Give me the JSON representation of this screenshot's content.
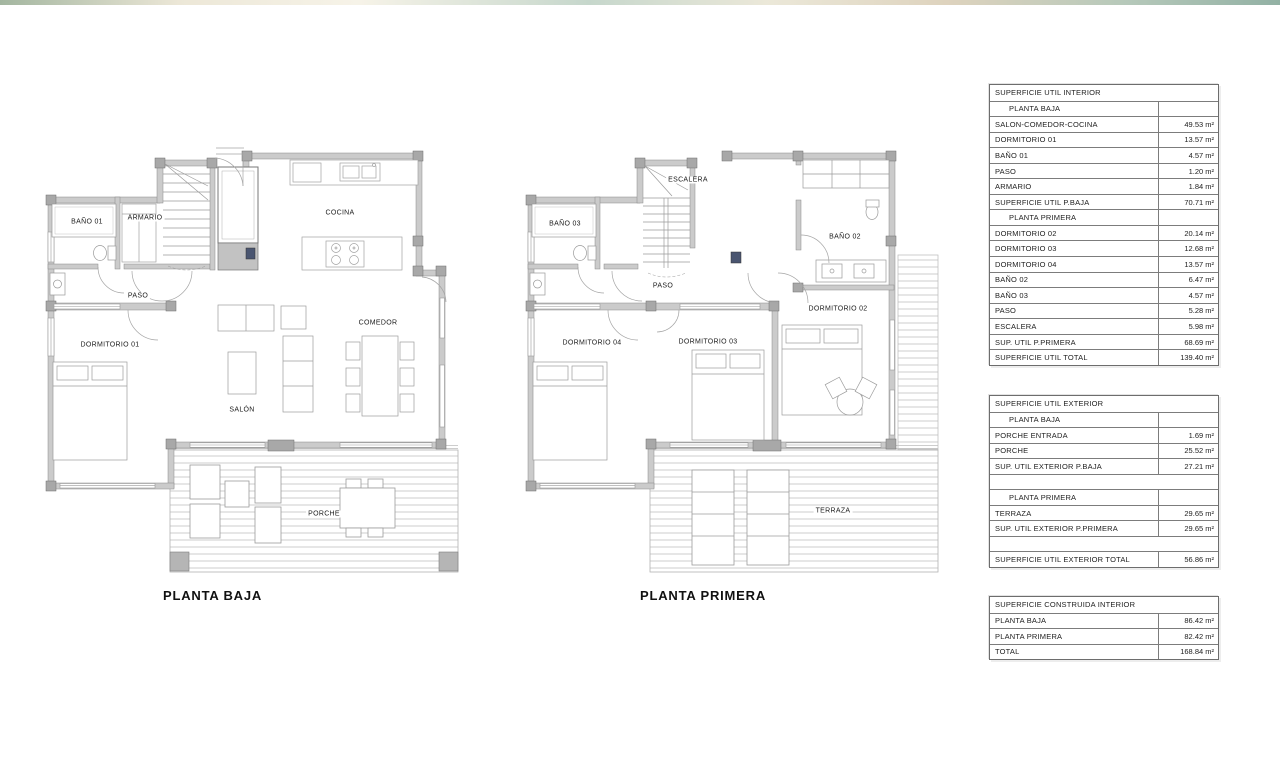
{
  "page": {
    "background": "#ffffff",
    "top_strip_colors": [
      "#93a98f",
      "#e9e3d0",
      "#bcd0c3",
      "#d8cbb2",
      "#7fa394"
    ],
    "wall_color": "#cbcbcb",
    "wall_outline": "#8a8a8a",
    "pad_color": "#aaaaaa",
    "line_color": "#9c9c9c",
    "deck_line_color": "#c9c9c9",
    "text_color": "#1b1b1b"
  },
  "plans": [
    {
      "title": "PLANTA BAJA",
      "rooms": [
        "BAÑO 01",
        "ARMARIO",
        "COCINA",
        "PASO",
        "DORMITORIO 01",
        "COMEDOR",
        "SALÓN",
        "PORCHE"
      ]
    },
    {
      "title": "PLANTA PRIMERA",
      "rooms": [
        "ESCALERA",
        "BAÑO 03",
        "BAÑO 02",
        "PASO",
        "DORMITORIO 04",
        "DORMITORIO 03",
        "DORMITORIO 02",
        "TERRAZA"
      ]
    }
  ],
  "tables": {
    "interior": {
      "rows": [
        {
          "label": "SUPERFICIE UTIL INTERIOR",
          "value": ""
        },
        {
          "label": "PLANTA BAJA",
          "value": ""
        },
        {
          "label": "SALON-COMEDOR-COCINA",
          "value": "49.53 m²"
        },
        {
          "label": "DORMITORIO 01",
          "value": "13.57 m²"
        },
        {
          "label": "BAÑO 01",
          "value": "4.57 m²"
        },
        {
          "label": "PASO",
          "value": "1.20 m²"
        },
        {
          "label": "ARMARIO",
          "value": "1.84 m²"
        },
        {
          "label": "SUPERFICIE UTIL P.BAJA",
          "value": "70.71 m²"
        },
        {
          "label": "PLANTA PRIMERA",
          "value": ""
        },
        {
          "label": "DORMITORIO 02",
          "value": "20.14 m²"
        },
        {
          "label": "DORMITORIO 03",
          "value": "12.68 m²"
        },
        {
          "label": "DORMITORIO 04",
          "value": "13.57 m²"
        },
        {
          "label": "BAÑO 02",
          "value": "6.47 m²"
        },
        {
          "label": "BAÑO 03",
          "value": "4.57 m²"
        },
        {
          "label": "PASO",
          "value": "5.28 m²"
        },
        {
          "label": "ESCALERA",
          "value": "5.98 m²"
        },
        {
          "label": "SUP. UTIL P.PRIMERA",
          "value": "68.69 m²"
        },
        {
          "label": "SUPERFICIE UTIL TOTAL",
          "value": "139.40 m²"
        }
      ]
    },
    "exterior": {
      "rows": [
        {
          "label": "SUPERFICIE UTIL EXTERIOR",
          "value": ""
        },
        {
          "label": "PLANTA BAJA",
          "value": ""
        },
        {
          "label": "PORCHE ENTRADA",
          "value": "1.69 m²"
        },
        {
          "label": "PORCHE",
          "value": "25.52 m²"
        },
        {
          "label": "SUP. UTIL EXTERIOR P.BAJA",
          "value": "27.21 m²"
        },
        {
          "label": "",
          "value": ""
        },
        {
          "label": "PLANTA PRIMERA",
          "value": ""
        },
        {
          "label": "TERRAZA",
          "value": "29.65 m²"
        },
        {
          "label": "SUP. UTIL EXTERIOR P.PRIMERA",
          "value": "29.65 m²"
        },
        {
          "label": "",
          "value": ""
        },
        {
          "label": "SUPERFICIE UTIL EXTERIOR TOTAL",
          "value": "56.86 m²"
        }
      ]
    },
    "construida": {
      "rows": [
        {
          "label": "SUPERFICIE CONSTRUIDA INTERIOR",
          "value": ""
        },
        {
          "label": "PLANTA BAJA",
          "value": "86.42 m²"
        },
        {
          "label": "PLANTA PRIMERA",
          "value": "82.42 m²"
        },
        {
          "label": "TOTAL",
          "value": "168.84 m²"
        }
      ]
    }
  }
}
